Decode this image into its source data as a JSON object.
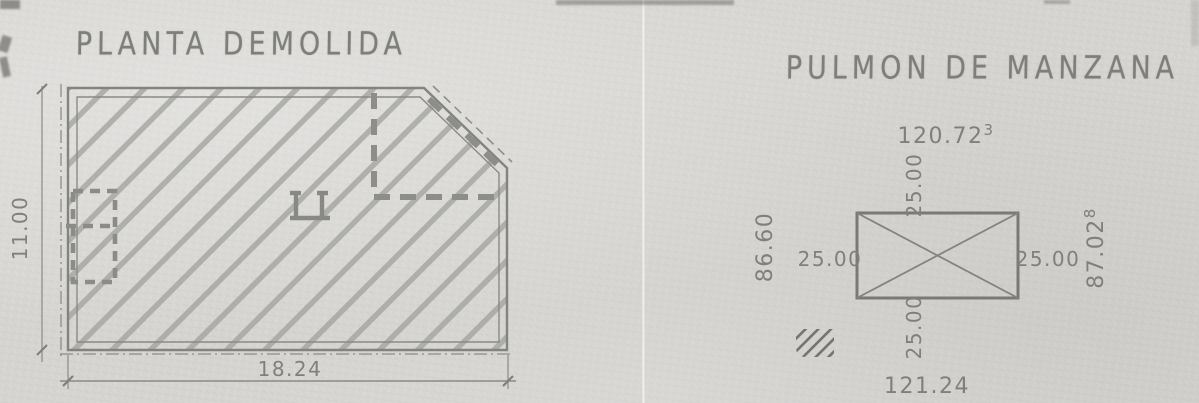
{
  "left_drawing": {
    "title": "PLANTA DEMOLIDA",
    "dim_height": "11.00",
    "dim_width": "18.24"
  },
  "right_drawing": {
    "title": "PULMON DE MANZANA",
    "dim_top": "120.72",
    "dim_top_sup": "3",
    "dim_bottom": "121.24",
    "dim_left": "86.60",
    "dim_right": "87.02",
    "dim_right_sup": "8",
    "offsets": {
      "top": "25.00",
      "bottom": "25.00",
      "left": "25.00",
      "right": "25.00"
    }
  },
  "colors": {
    "paper": "#d6d5d2",
    "ink": "#868682",
    "hatch": "#a0a09c",
    "heavy_ink": "#8c8c88"
  }
}
